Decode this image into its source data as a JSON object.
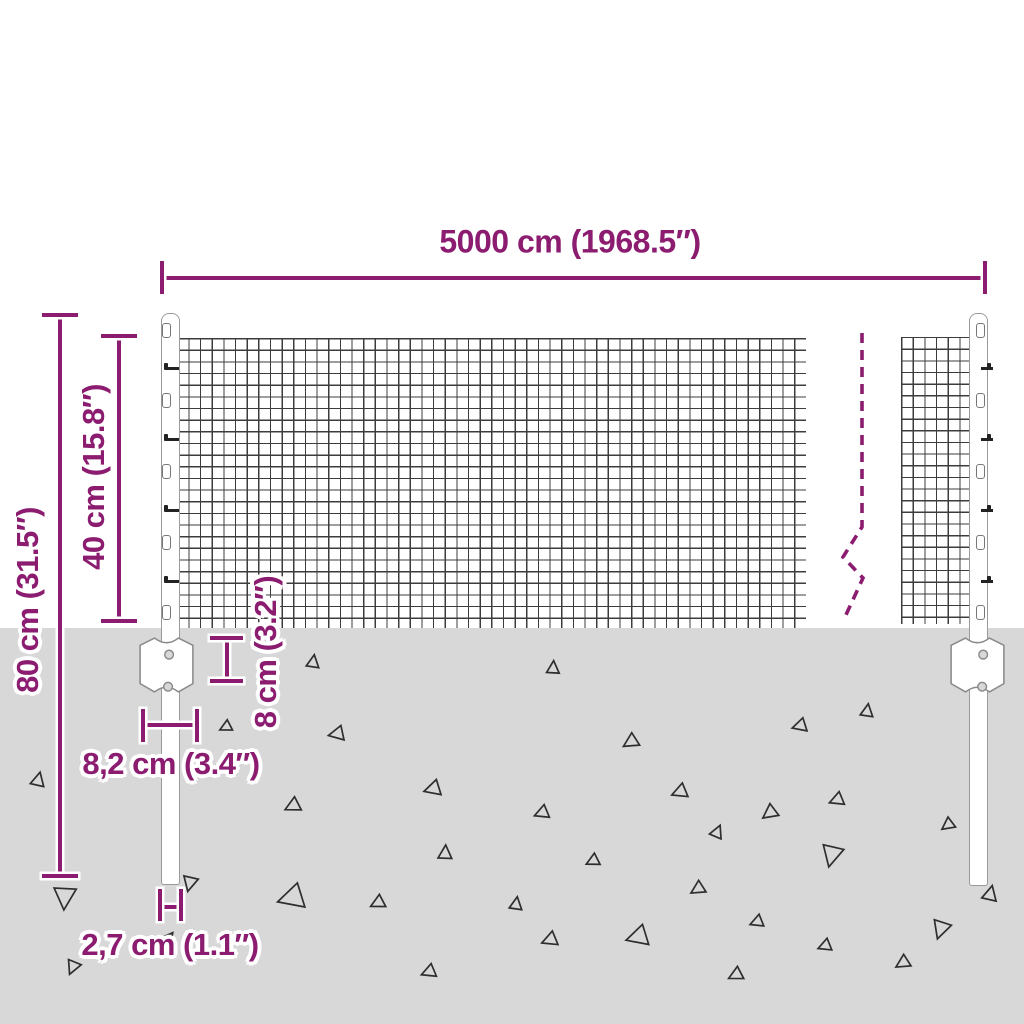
{
  "diagram_title": "Wire mesh fence with posts - dimension diagram",
  "colors": {
    "accent": "#8b1c6f",
    "ground": "#d8d8d8",
    "mesh_line": "#3c3c3c",
    "outline": "#9a9a9a",
    "triangle_line": "#2e2e2e",
    "background": "#ffffff"
  },
  "dimensions": {
    "total_width": {
      "label": "5000 cm (1968.5″)"
    },
    "post_height": {
      "label": "80 cm (31.5″)"
    },
    "mesh_height": {
      "label": "40 cm (15.8″)"
    },
    "anchor_depth": {
      "label": "8 cm (3.2″)"
    },
    "anchor_width": {
      "label": "8,2 cm (3.4″)"
    },
    "post_width": {
      "label": "2,7 cm (1.1″)"
    }
  },
  "ground": {
    "triangles": [
      [
        38,
        780,
        13,
        15
      ],
      [
        65,
        897,
        21,
        185
      ],
      [
        73,
        967,
        13,
        205
      ],
      [
        190,
        883,
        14,
        195
      ],
      [
        170,
        936,
        7,
        40
      ],
      [
        292,
        898,
        24,
        255
      ],
      [
        293,
        806,
        14,
        245
      ],
      [
        313,
        662,
        12,
        10
      ],
      [
        337,
        734,
        14,
        260
      ],
      [
        226,
        727,
        11,
        245
      ],
      [
        433,
        789,
        15,
        255
      ],
      [
        542,
        813,
        13,
        250
      ],
      [
        553,
        668,
        12,
        5
      ],
      [
        631,
        742,
        14,
        240
      ],
      [
        800,
        726,
        13,
        255
      ],
      [
        867,
        711,
        12,
        10
      ],
      [
        680,
        792,
        14,
        250
      ],
      [
        770,
        813,
        14,
        235
      ],
      [
        837,
        800,
        13,
        250
      ],
      [
        948,
        825,
        12,
        235
      ],
      [
        717,
        832,
        12,
        25
      ],
      [
        378,
        903,
        13,
        245
      ],
      [
        445,
        853,
        13,
        5
      ],
      [
        516,
        904,
        12,
        10
      ],
      [
        550,
        940,
        14,
        250
      ],
      [
        593,
        861,
        12,
        245
      ],
      [
        638,
        937,
        20,
        255
      ],
      [
        698,
        889,
        13,
        240
      ],
      [
        757,
        922,
        12,
        250
      ],
      [
        736,
        975,
        13,
        245
      ],
      [
        429,
        972,
        13,
        250
      ],
      [
        990,
        894,
        14,
        15
      ],
      [
        941,
        929,
        17,
        200
      ],
      [
        825,
        946,
        12,
        250
      ],
      [
        903,
        963,
        13,
        240
      ],
      [
        832,
        855,
        20,
        195
      ]
    ]
  },
  "posts": {
    "clip_rows": [
      331,
      366,
      401,
      437,
      472,
      508,
      543,
      579,
      613
    ]
  }
}
